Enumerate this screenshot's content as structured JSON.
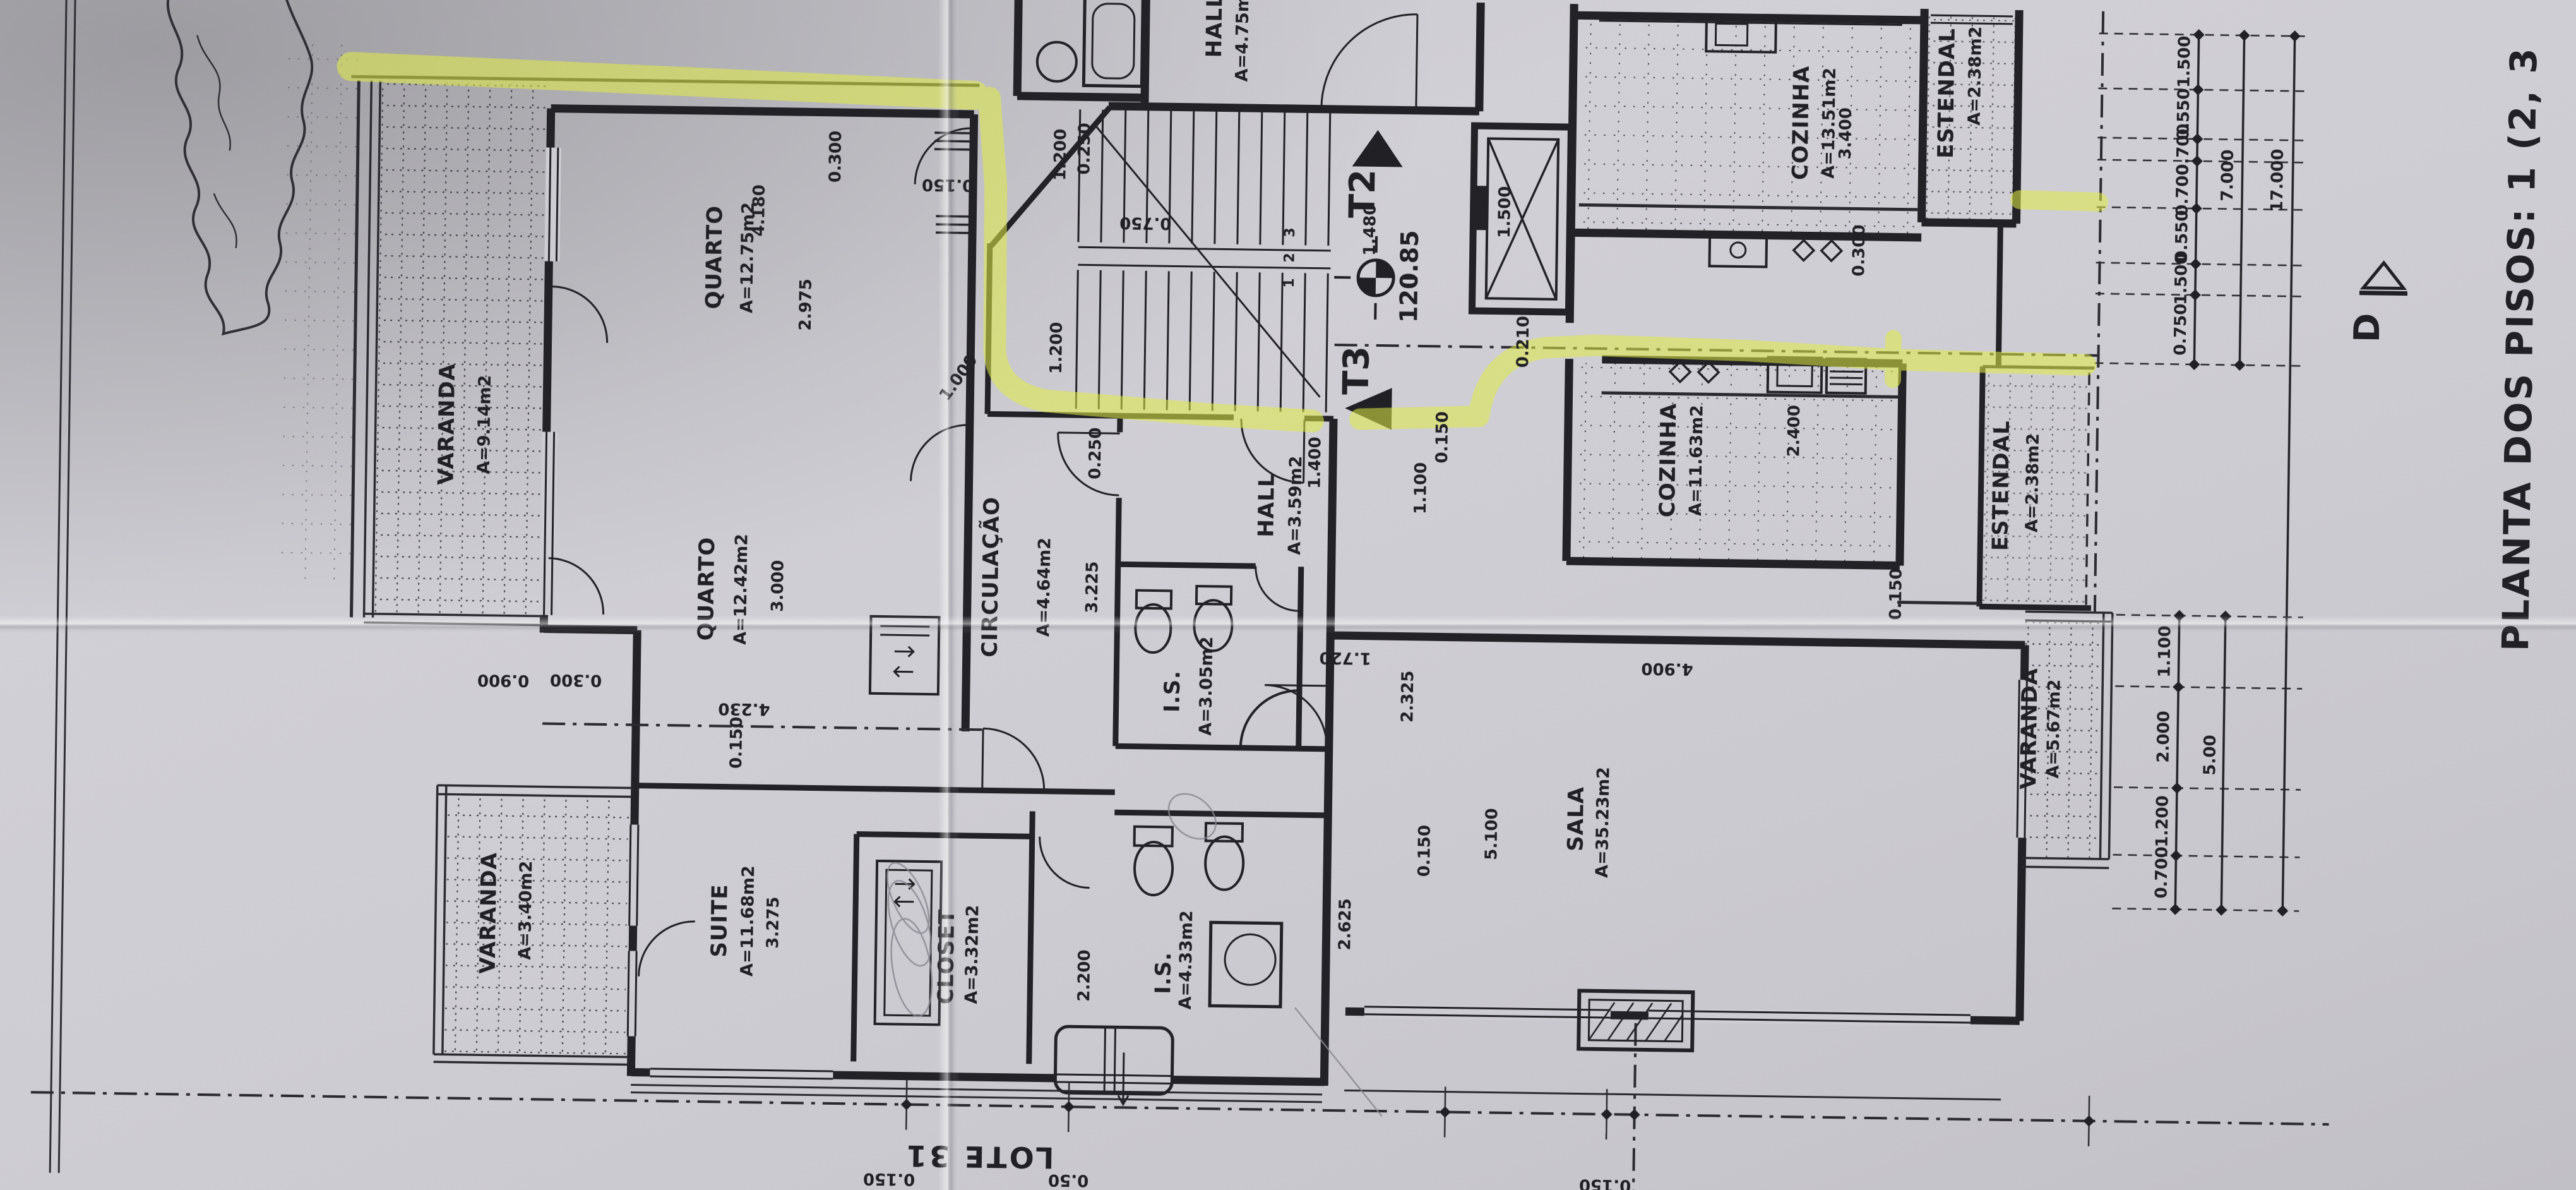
{
  "title": {
    "text": "PLANTA DOS PISOS: 1 (2, 3"
  },
  "markers": {
    "t2": "T2",
    "t3": "T3",
    "level": "120.85",
    "landing": "1.480",
    "lot": "LOTE 31",
    "section": "D",
    "steps": [
      "1",
      "2",
      "3"
    ]
  },
  "rooms": [
    {
      "name": "VARANDA",
      "area": "A=9.14m2"
    },
    {
      "name": "QUARTO",
      "area": "A=12.75m2"
    },
    {
      "name": "QUARTO",
      "area": "A=12.42m2"
    },
    {
      "name": "CIRCULAÇÃO",
      "area": "A=4.64m2"
    },
    {
      "name": "HALL",
      "area": "A=3.59m2"
    },
    {
      "name": "HALL",
      "area": "A=4.75m2"
    },
    {
      "name": "COZINHA",
      "area": "A=13.51m2"
    },
    {
      "name": "ESTENDAL",
      "area": "A=2.38m2"
    },
    {
      "name": "COZINHA",
      "area": "A=11.63m2"
    },
    {
      "name": "ESTENDAL",
      "area": "A=2.38m2"
    },
    {
      "name": "SALA",
      "area": "A=35.23m2"
    },
    {
      "name": "VARANDA",
      "area": "A=5.67m2"
    },
    {
      "name": "SUITE",
      "area": "A=11.68m2"
    },
    {
      "name": "CLOSET",
      "area": "A=3.32m2"
    },
    {
      "name": "I.S.",
      "area": "A=4.33m2"
    },
    {
      "name": "I.S.",
      "area": "A=3.05m2"
    },
    {
      "name": "VARANDA",
      "area": "A=3.40m2"
    }
  ],
  "dims": {
    "interior": [
      "0.300",
      "2.975",
      "4.180",
      "0.150",
      "1.200",
      "0.250",
      "0.750",
      "1.200",
      "1.000",
      "0.250",
      "3.225",
      "1.400",
      "1.100",
      "1.720",
      "2.325",
      "0.150",
      "5.100",
      "4.900",
      "2.625",
      "2.200",
      "3.275",
      "3.000",
      "4.230",
      "0.300",
      "0.900",
      "0.150",
      "0.300",
      "1.500",
      "0.210",
      "3.400",
      "2.400",
      "0.150",
      "0.150",
      "0.50",
      "0.150",
      "0.400",
      "0.150"
    ],
    "right_chain": [
      "1.500",
      "0.550",
      "0.700",
      "0.700",
      "0.550",
      "1.500",
      "0.750"
    ],
    "lower_chain": [
      "1.100",
      "2.000",
      "1.200",
      "0.700"
    ],
    "totals": [
      "7.000",
      "17.000",
      "5.00"
    ]
  },
  "colors": {
    "highlight": "#e2ef3f",
    "ink": "#1b1b20",
    "paper": "#cfced4"
  }
}
